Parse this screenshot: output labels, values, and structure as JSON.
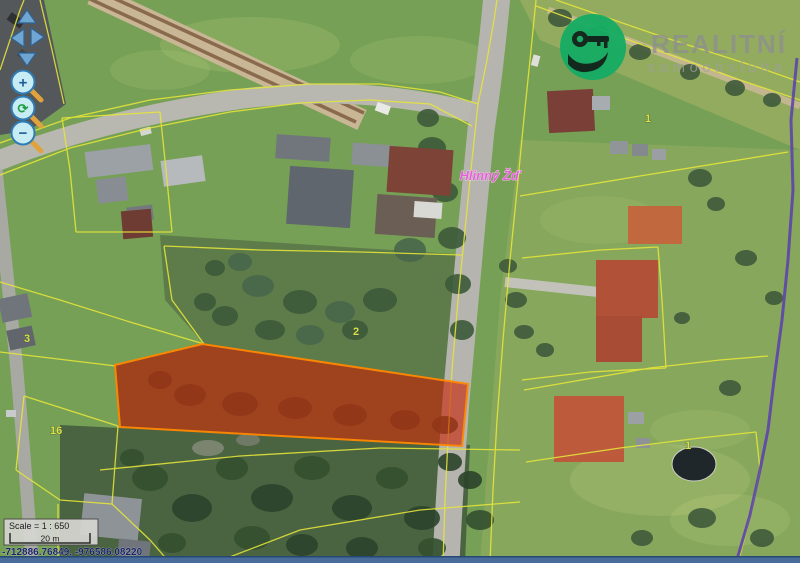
{
  "colors": {
    "cadastral_line": "#e6e63a",
    "parcel_fill": "#cc1e04",
    "parcel_stroke": "#ff8800",
    "municipal_boundary": "#5b3db0",
    "logo_green": "#15ac64",
    "logo_text_gray": "#8f8f8f",
    "town_label_pink": "#e361d6",
    "parcel_number_yellow": "#d9e24a",
    "pan_arrow_blue": "#74b0e0",
    "button_fill": "#c8ecf4",
    "button_stroke": "#2f7cb5",
    "bottom_bar_blue": "#4a6c9b"
  },
  "logo": {
    "title": "REALITNÍ",
    "subtitle": "samoobsluha"
  },
  "controls": {
    "zoom_in_label": "+",
    "zoom_out_label": "−",
    "refresh_label": "⟳"
  },
  "map": {
    "town_label": "Hlinný Žď",
    "parcel_numbers": [
      {
        "text": "2"
      },
      {
        "text": "16"
      },
      {
        "text": "1"
      },
      {
        "text": "1"
      },
      {
        "text": "3"
      }
    ]
  },
  "scalebar": {
    "scale_text": "Scale = 1 : 650",
    "bar_label": "20 m"
  },
  "statusbar": {
    "coordinates": "-712886.76849, -976586.08220"
  }
}
